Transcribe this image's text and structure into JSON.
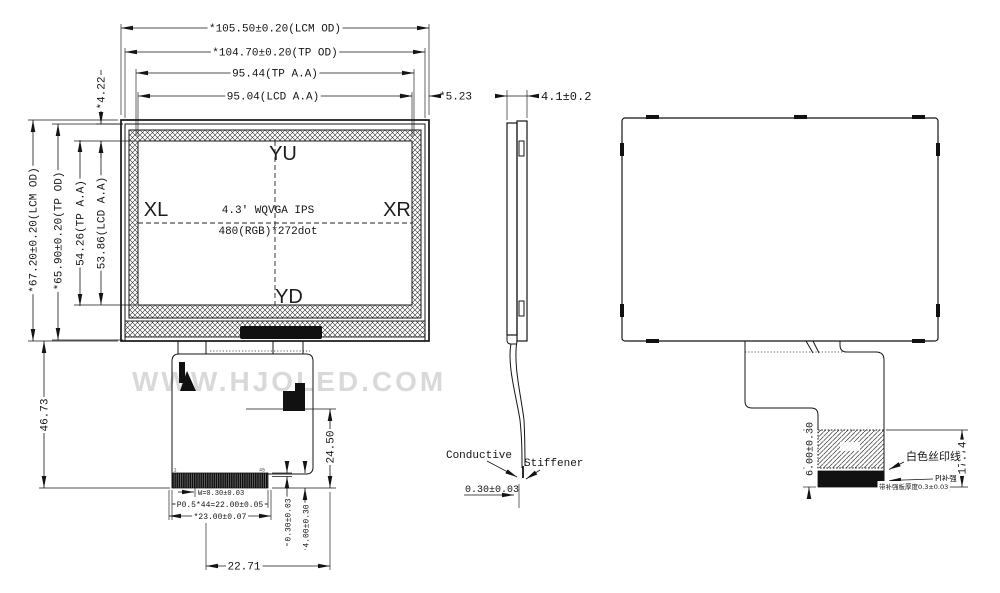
{
  "watermark": "WWW.HJOLED.COM",
  "front": {
    "dim_lcm_w": "*105.50±0.20(LCM OD)",
    "dim_tp_w": "*104.70±0.20(TP OD)",
    "dim_tpaa_w": "95.44(TP A.A)",
    "dim_lcdaa_w": "95.04(LCD A.A)",
    "dim_right_gap": "*5.23",
    "dim_top_gap": "*4.22",
    "dim_lcm_h": "*67.20±0.20(LCM OD)",
    "dim_tp_h": "*65.90±0.20(TP OD)",
    "dim_tpaa_h": "54.26(TP A.A)",
    "dim_lcdaa_h": "53.86(LCD A.A)",
    "marker_top": "YU",
    "marker_left": "XL",
    "marker_right": "XR",
    "marker_bottom": "YD",
    "panel_line1": "4.3' WQVGA IPS",
    "panel_line2": "480(RGB)*272dot",
    "dim_fpc_drop": "46.73",
    "dim_fpc_len": "24.50",
    "pin_first": "1",
    "pin_last": "45",
    "dim_pin_w": "W=0.30±0.03",
    "dim_pitch": "P0.5*44=22.00±0.05",
    "dim_conn_w": "*23.00±0.07",
    "dim_conn_t": "0.30±0.03",
    "dim_conn_h": "4.00±0.30",
    "dim_conn_off": "22.71"
  },
  "side": {
    "dim_thickness": "4.1±0.2",
    "conductive": "Conductive",
    "stiffener": "Stiffener",
    "dim_fpc_t": "0.30±0.03"
  },
  "back": {
    "dim_stiff_h": "6.00±0.30",
    "dim_tail_len": "17.74",
    "silkscreen": "白色丝印线",
    "pi": "PI补强",
    "thickness_note": "带补强板厚度0.3±0.03"
  }
}
